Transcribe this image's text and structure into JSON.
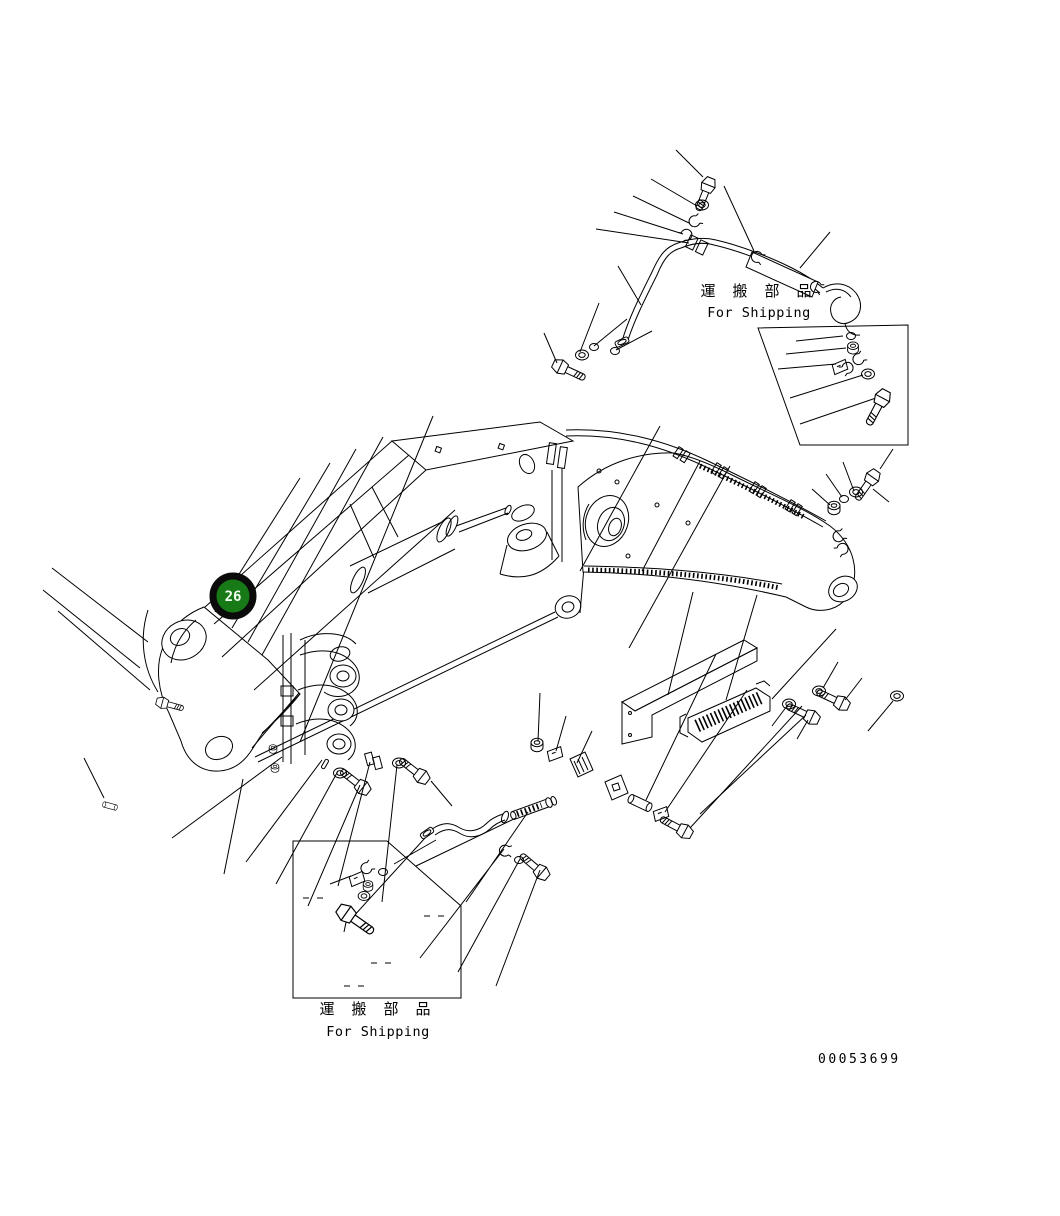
{
  "document": {
    "doc_number": "00053699",
    "background": "#ffffff",
    "line_color": "#000000"
  },
  "callout": {
    "label": "26",
    "fill": "#177a17",
    "ring": "#0b0b0b",
    "text_color": "#f2fff2"
  },
  "shipping_labels": {
    "top_right": {
      "jp": "運 搬 部 品",
      "en": "For Shipping"
    },
    "bottom_left": {
      "jp": "運 搬 部 品",
      "en": "For Shipping"
    }
  }
}
